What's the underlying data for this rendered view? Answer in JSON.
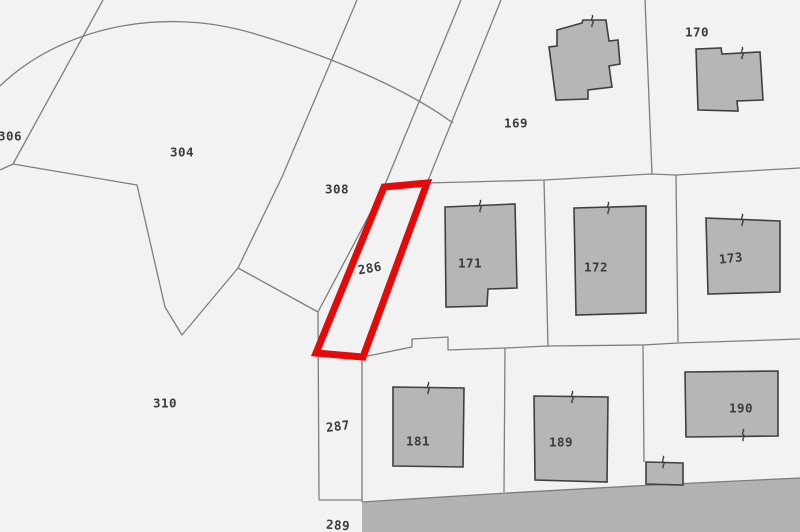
{
  "map": {
    "type": "cadastral-parcel-map",
    "colors": {
      "background": "#f2f2f2",
      "boundary_line": "#7e7e7e",
      "building_fill": "#b6b6b6",
      "building_stroke": "#3f3f3f",
      "road_fill": "#b2b2b2",
      "highlight": "#e60909",
      "label": "#3b3b3b"
    },
    "highlight": {
      "parcel": "286",
      "points": "384,187 427,183 363,357 316,353",
      "stroke_width": 7
    },
    "road": {
      "name": "road-area",
      "points": "362,502 507,493 653,485 800,478 800,532 362,532"
    },
    "arc_path": "M 0,86 C 60,28 160,6 252,33 C 330,56 405,88 453,123",
    "boundary_lines": [
      {
        "name": "boundary-306-304",
        "points": "103,0 13,164 0,170"
      },
      {
        "name": "boundary-304-310",
        "points": "13,164 137,185 165,307 182,335 238,268"
      },
      {
        "name": "boundary-304-308",
        "points": "357,0 282,177 238,268"
      },
      {
        "name": "boundary-308-286",
        "points": "461,0 384,187 318,312"
      },
      {
        "name": "boundary-road-east",
        "points": "501,0 427,183"
      },
      {
        "name": "boundary-308-310",
        "points": "238,268 318,312"
      },
      {
        "name": "boundary-287-west",
        "points": "318,312 319,500"
      },
      {
        "name": "boundary-287-289",
        "points": "319,500 362,500"
      },
      {
        "name": "boundary-287-east",
        "points": "362,357 362,502"
      },
      {
        "name": "boundary-row1-north",
        "points": "427,183 544,180 651,174 676,175 800,168"
      },
      {
        "name": "boundary-169-170",
        "points": "645,0 652,174"
      },
      {
        "name": "boundary-171-172",
        "points": "544,180 548,347"
      },
      {
        "name": "boundary-172-173",
        "points": "676,175 678,342"
      },
      {
        "name": "boundary-row2-north",
        "points": "363,357 412,347 412,339 448,337 448,350 505,348 548,346 643,345 678,343 800,339"
      },
      {
        "name": "boundary-181-189",
        "points": "505,348 504,492"
      },
      {
        "name": "boundary-189-190",
        "points": "643,345 644,462"
      },
      {
        "name": "boundary-road-north",
        "points": "362,502 507,493 653,485 800,478"
      }
    ],
    "buildings": [
      {
        "name": "building-169",
        "points": "557,30 582,23 583,20 606,20 609,41 618,40 620,64 609,66 612,87 588,90 588,99 556,100 549,47 557,46",
        "tick": {
          "x": 592,
          "y": 21
        }
      },
      {
        "name": "building-170",
        "points": "696,49 721,48 722,54 760,52 763,100 737,101 738,111 698,110",
        "tick": {
          "x": 742,
          "y": 53
        }
      },
      {
        "name": "building-171",
        "points": "445,207 515,204 517,288 488,289 487,306 446,307",
        "tick": {
          "x": 480,
          "y": 206
        }
      },
      {
        "name": "building-172",
        "points": "574,208 646,206 646,313 576,315",
        "tick": {
          "x": 608,
          "y": 208
        }
      },
      {
        "name": "building-173",
        "points": "706,218 780,221 780,292 708,294",
        "tick": {
          "x": 742,
          "y": 220
        }
      },
      {
        "name": "building-181",
        "points": "393,387 464,388 463,467 393,466",
        "tick": {
          "x": 428,
          "y": 388
        }
      },
      {
        "name": "building-189",
        "points": "534,396 608,397 607,482 535,480",
        "tick": {
          "x": 572,
          "y": 397
        }
      },
      {
        "name": "building-190",
        "points": "685,372 778,371 778,436 686,437",
        "tick": {
          "x": 743,
          "y": 435
        }
      },
      {
        "name": "building-annex-190",
        "points": "646,462 683,463 683,485 646,484",
        "tick": {
          "x": 663,
          "y": 462
        }
      }
    ],
    "labels": [
      {
        "id": "306",
        "text": "306",
        "x": 10,
        "y": 137,
        "rot": 0
      },
      {
        "id": "304",
        "text": "304",
        "x": 182,
        "y": 153,
        "rot": 0
      },
      {
        "id": "308",
        "text": "308",
        "x": 337,
        "y": 190,
        "rot": 0
      },
      {
        "id": "286",
        "text": "286",
        "x": 370,
        "y": 269,
        "rot": -10
      },
      {
        "id": "310",
        "text": "310",
        "x": 165,
        "y": 404,
        "rot": 0
      },
      {
        "id": "287",
        "text": "287",
        "x": 338,
        "y": 427,
        "rot": -7
      },
      {
        "id": "289",
        "text": "289",
        "x": 338,
        "y": 526,
        "rot": 4
      },
      {
        "id": "169",
        "text": "169",
        "x": 516,
        "y": 124,
        "rot": 0
      },
      {
        "id": "170",
        "text": "170",
        "x": 697,
        "y": 33,
        "rot": 0
      },
      {
        "id": "171",
        "text": "171",
        "x": 470,
        "y": 264,
        "rot": 0
      },
      {
        "id": "172",
        "text": "172",
        "x": 596,
        "y": 268,
        "rot": 0
      },
      {
        "id": "173",
        "text": "173",
        "x": 731,
        "y": 259,
        "rot": -6
      },
      {
        "id": "181",
        "text": "181",
        "x": 418,
        "y": 442,
        "rot": 0
      },
      {
        "id": "189",
        "text": "189",
        "x": 561,
        "y": 443,
        "rot": 0
      },
      {
        "id": "190",
        "text": "190",
        "x": 741,
        "y": 409,
        "rot": 0
      }
    ],
    "tick_symbol_path": "M 0,-6 C 2.5,-4 -2.5,-2 0.5,0 C 3,2 -2,4 0.5,6"
  }
}
